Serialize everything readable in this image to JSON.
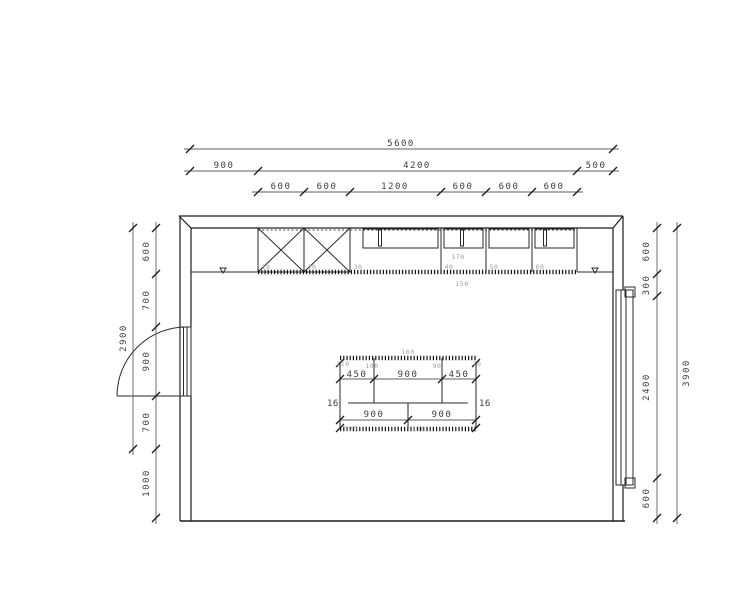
{
  "drawing": {
    "type": "kitchen-floor-plan",
    "line_color": "#1c1c1c",
    "dim_color": "#3d3d3d",
    "label_color": "#9f9f9f"
  },
  "dims": {
    "top": {
      "overall": "5600",
      "row2": [
        "900",
        "4200",
        "500"
      ],
      "row3": [
        "600",
        "600",
        "1200",
        "600",
        "600",
        "600"
      ]
    },
    "left": {
      "chain": [
        "600",
        "700",
        "900",
        "700",
        "1000"
      ],
      "overall": "2900"
    },
    "right": {
      "chain": [
        "600",
        "300",
        "2400",
        "600"
      ],
      "overall": "3900"
    }
  },
  "cabinets": {
    "labels": [
      "10",
      "20",
      "30",
      "40",
      "50",
      "60"
    ],
    "worktop_label": "170",
    "plinth_label": "150"
  },
  "island": {
    "dims_top": [
      "450",
      "900",
      "450"
    ],
    "dims_bottom": [
      "900",
      "900"
    ],
    "panel_left": "16",
    "panel_right": "16",
    "labels": {
      "top": "160",
      "tl": "110",
      "tm": "100",
      "tr": "90",
      "corner": "70",
      "bl": "120",
      "br": "130"
    }
  }
}
